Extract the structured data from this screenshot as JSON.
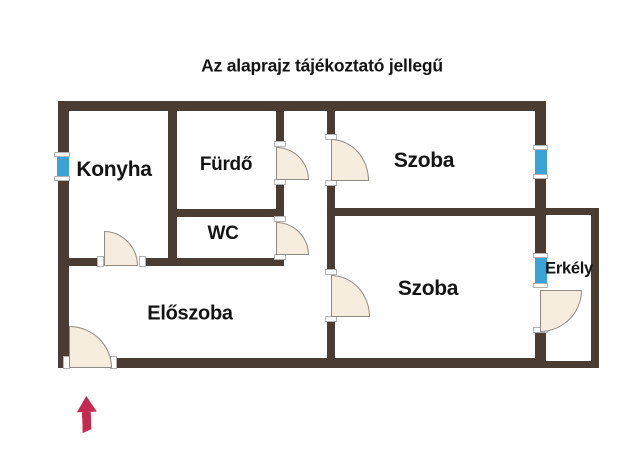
{
  "title": "Az alaprajz tájékoztató jellegű",
  "rooms": [
    {
      "id": "konyha",
      "label": "Konyha"
    },
    {
      "id": "furdo",
      "label": "Fürdő"
    },
    {
      "id": "wc",
      "label": "WC"
    },
    {
      "id": "szoba-felso",
      "label": "Szoba"
    },
    {
      "id": "szoba-also",
      "label": "Szoba"
    },
    {
      "id": "eloszoba",
      "label": "Előszoba"
    },
    {
      "id": "erkely",
      "label": "Erkély"
    }
  ],
  "colors": {
    "wall": "#4b3c33",
    "window": "#3aa2d7",
    "door_fill": "#f6eddf",
    "door_stroke": "#8e8a84",
    "arrow": "#c5294e",
    "background": "#ffffff",
    "text": "#141414"
  }
}
